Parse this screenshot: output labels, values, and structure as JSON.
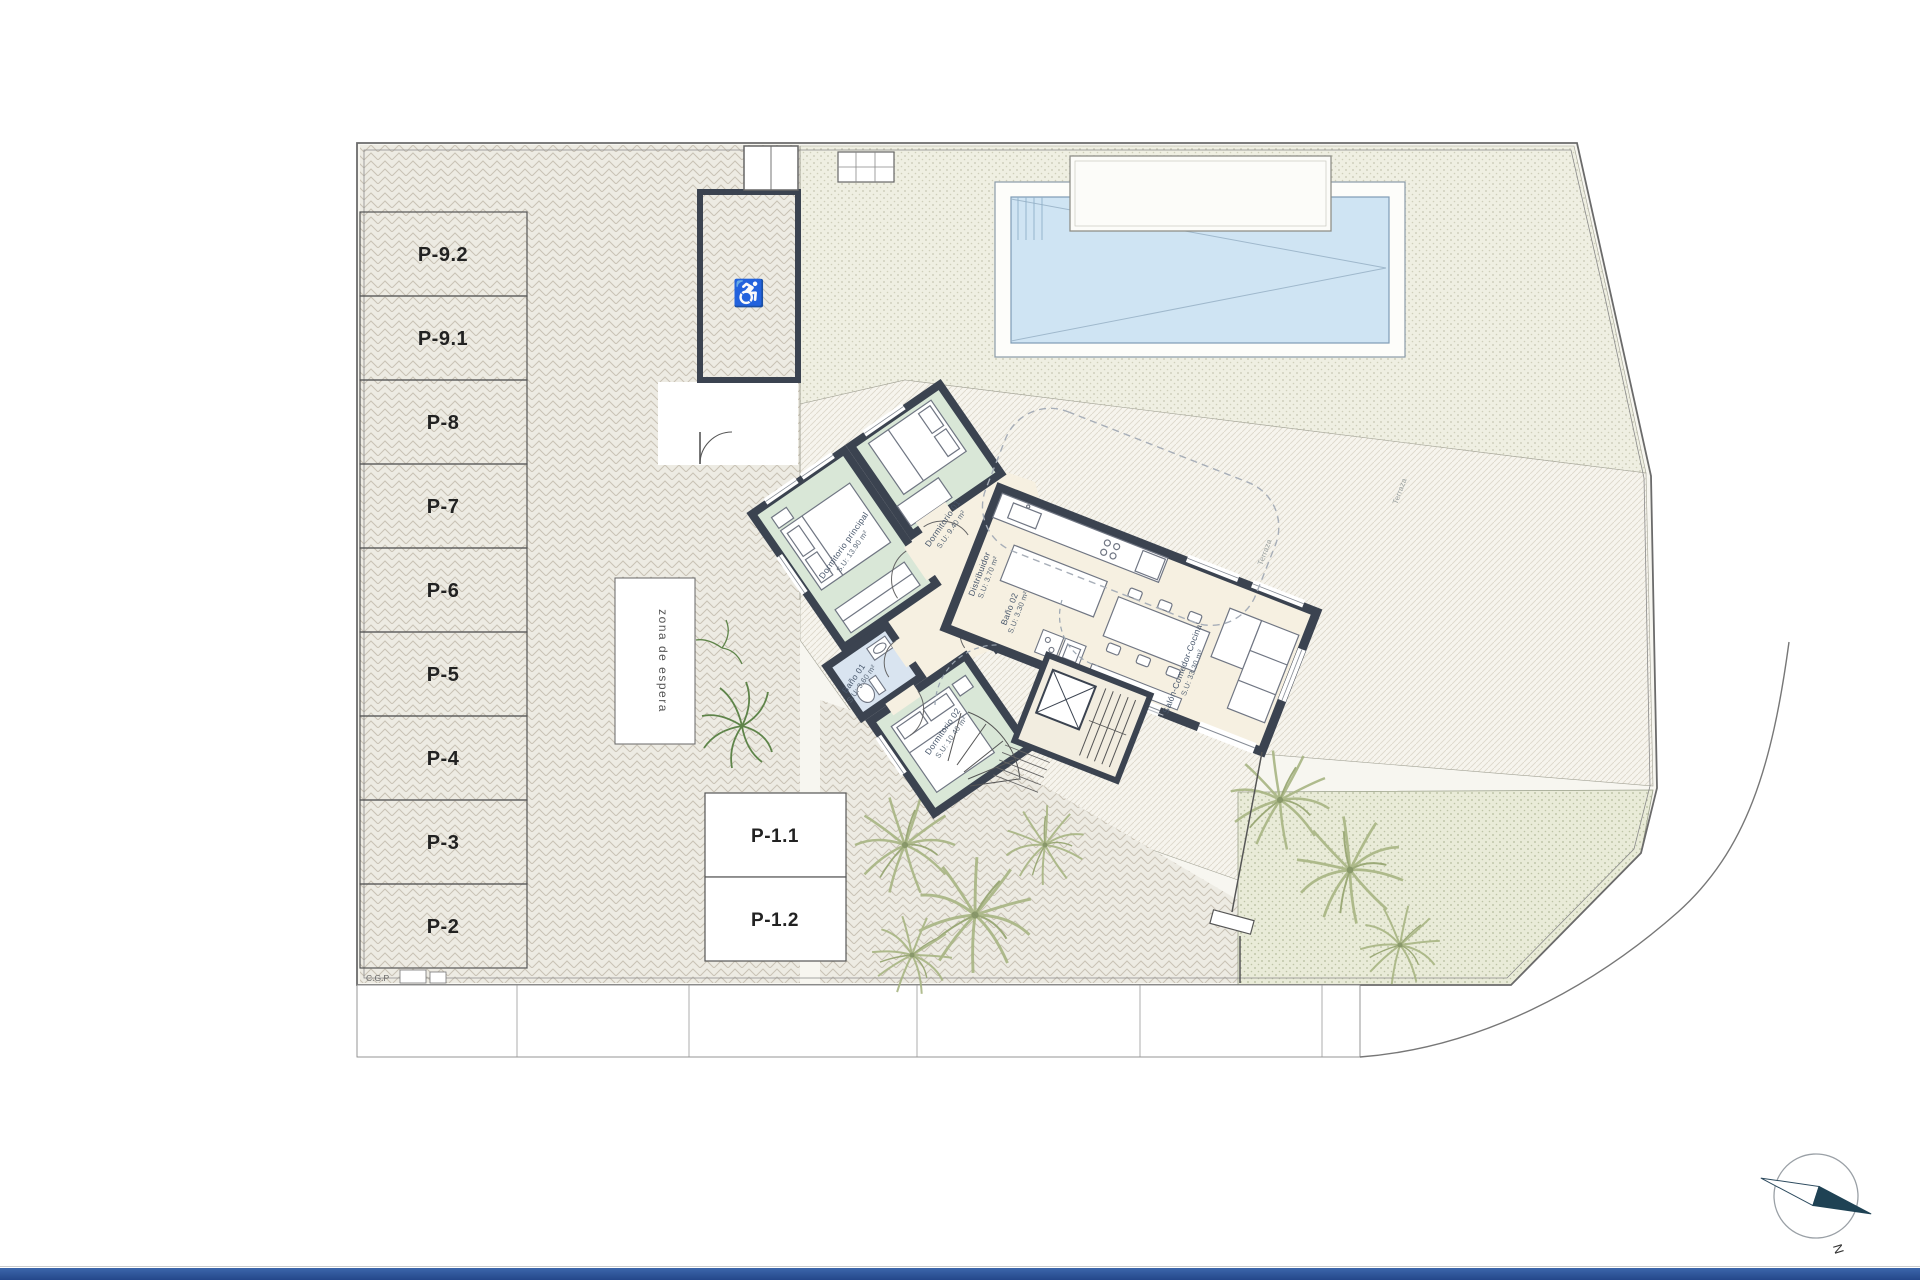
{
  "site": {
    "corner_label": "C.G.P",
    "waiting_zone_label": "zona de espera",
    "compass_label": "N"
  },
  "parking": {
    "stalls": [
      {
        "label": "P-9.2"
      },
      {
        "label": "P-9.1"
      },
      {
        "label": "P-8"
      },
      {
        "label": "P-7"
      },
      {
        "label": "P-6"
      },
      {
        "label": "P-5"
      },
      {
        "label": "P-4"
      },
      {
        "label": "P-3"
      },
      {
        "label": "P-2"
      }
    ],
    "front_stalls": [
      {
        "label": "P-1.1"
      },
      {
        "label": "P-1.2"
      }
    ]
  },
  "rooms": {
    "dormitorio_principal": {
      "name": "Dormitorio principal",
      "area": "S.U: 13.90 m²"
    },
    "dormitorio_01": {
      "name": "Dormitorio 01",
      "area": "S.U: 9.40 m²"
    },
    "dormitorio_02": {
      "name": "Dormitorio 02",
      "area": "S.U: 10.40 m²"
    },
    "bano_01": {
      "name": "Baño 01",
      "area": "S.U: 3.60 m²"
    },
    "bano_02": {
      "name": "Baño 02",
      "area": "S.U: 3.30 m²"
    },
    "distribuidor": {
      "name": "Distribuidor",
      "area": "S.U: 3.70 m²"
    },
    "salon": {
      "name": "Salón-Comedor-Cocina",
      "area": "S.U: 33.30 m²"
    },
    "terraza_1": {
      "name": "Terraza"
    },
    "terraza_2": {
      "name": "Terraza"
    }
  },
  "icons": {
    "accessible": "♿"
  },
  "colors": {
    "wall": "#3b4350",
    "bedroom_green": "#d9e7d7",
    "bathroom_blue": "#d9e4f0",
    "living_cream": "#f6f0e1",
    "pool_water": "#cfe4f3",
    "footer_blue": "#2d5ba6",
    "plant_green": "#a8b583"
  }
}
